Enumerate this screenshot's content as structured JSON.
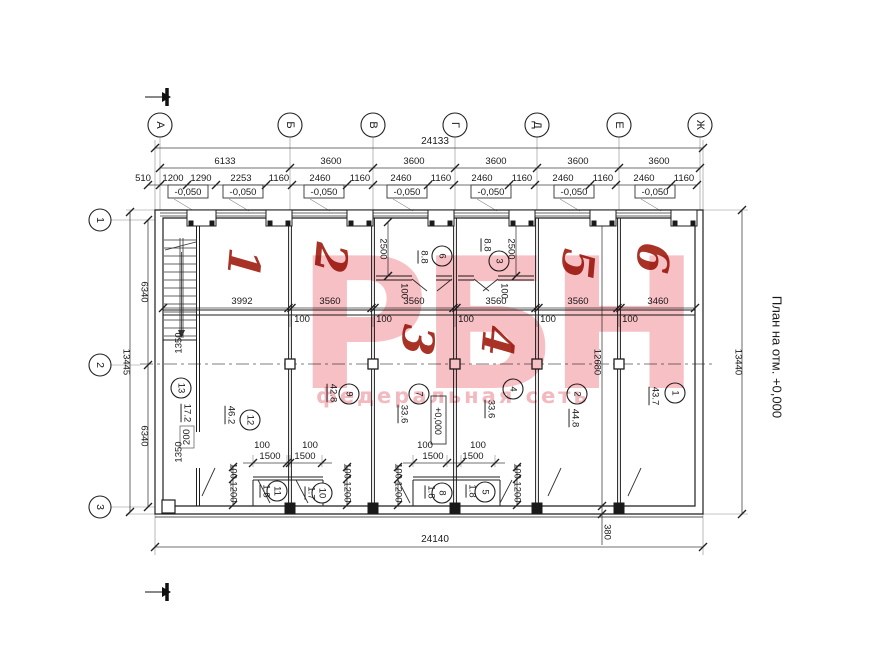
{
  "plan_title": "План на отм. +0,000",
  "watermark": {
    "logo": "РБН",
    "subtitle": "федеральная сеть"
  },
  "axes_cols": [
    "А",
    "Б",
    "В",
    "Г",
    "Д",
    "Е",
    "Ж"
  ],
  "axes_rows": [
    "1",
    "2",
    "3"
  ],
  "elevation_minus": "-0,050",
  "elevation_zero": "+0,000",
  "red_marks": [
    "1",
    "2",
    "3",
    "4",
    "5",
    "6"
  ],
  "dims": {
    "top_total": "24133",
    "bottom_total": "24140",
    "spans": [
      "6133",
      "3600",
      "3600",
      "3600",
      "3600",
      "3600"
    ],
    "detail": [
      "510",
      "1200",
      "1290",
      "2253",
      "1160",
      "2460",
      "1160",
      "2460",
      "1160",
      "2460",
      "1160",
      "2460",
      "1160",
      "2460",
      "1160"
    ],
    "left_total": "13445",
    "left_half": [
      "6340",
      "6340"
    ],
    "stair": [
      "1350",
      "200",
      "1350"
    ],
    "right_total": "13440",
    "right_inner": "12680",
    "wall_380": "380",
    "mid": [
      "3992",
      "3560",
      "3560",
      "3560",
      "3560",
      "3460"
    ],
    "wall100": "100",
    "vest_2500": "2500",
    "wc_1500": "1500",
    "wc_1200": "1200"
  },
  "rooms": [
    {
      "num": "13",
      "area": "17.2"
    },
    {
      "num": "12",
      "area": "46.2"
    },
    {
      "num": "9",
      "area": "42.8"
    },
    {
      "num": "7",
      "area": "33.6"
    },
    {
      "num": "4",
      "area": "33.6"
    },
    {
      "num": "2",
      "area": "44.8"
    },
    {
      "num": "1",
      "area": "43.7"
    },
    {
      "num": "6",
      "area": "8.8"
    },
    {
      "num": "3",
      "area": "8.8"
    },
    {
      "num": "11",
      "area": "1.8"
    },
    {
      "num": "10",
      "area": "1.7"
    },
    {
      "num": "8",
      "area": "1.8"
    },
    {
      "num": "5",
      "area": "1.8"
    }
  ]
}
